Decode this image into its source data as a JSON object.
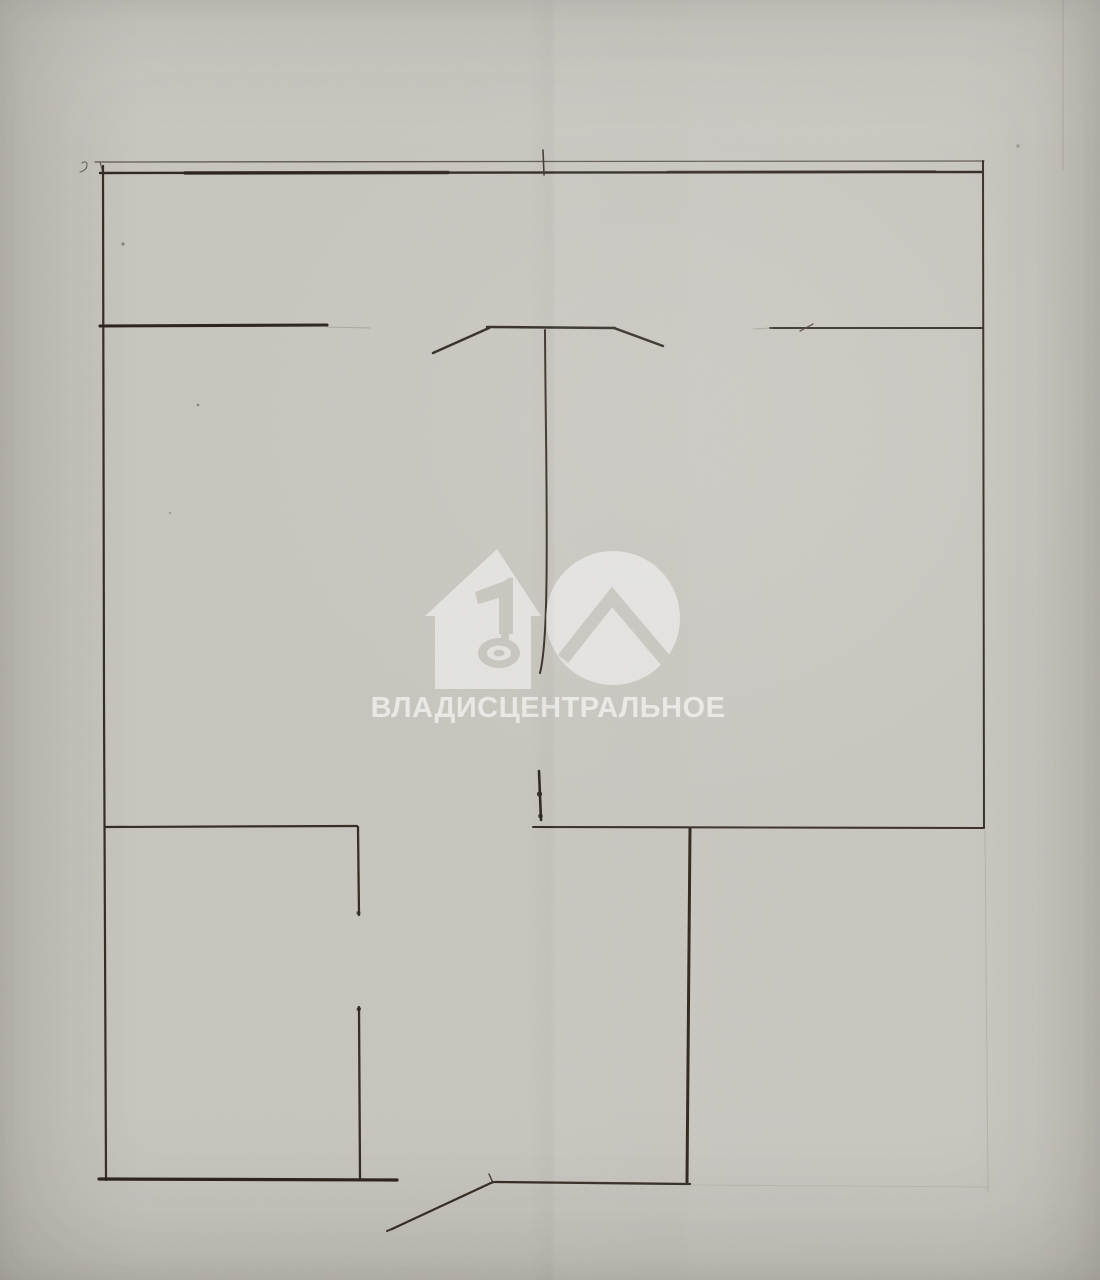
{
  "watermark": {
    "label": "ВЛАДИСЦЕНТРАЛЬНОЕ",
    "fill_color": "rgba(255,255,255,0.5)",
    "logo_icons": [
      "house-icon",
      "number-1-key-icon",
      "circle-roof-icon"
    ]
  },
  "paper": {
    "base_color": "#c7c5be",
    "ink_color": "#2e2720",
    "crease_color": "#a3998b"
  },
  "floorplan": {
    "description": "hand-drawn apartment floor plan",
    "lines": [
      {
        "x1": 95,
        "y1": 162,
        "x2": 984,
        "y2": 161,
        "w": 1.3,
        "c": "#5a5249",
        "o": 0.95
      },
      {
        "x1": 100,
        "y1": 162,
        "x2": 103,
        "y2": 173,
        "w": 1.2,
        "c": "#5a5249",
        "o": 0.9
      },
      {
        "x1": 100,
        "y1": 173,
        "x2": 983,
        "y2": 172,
        "w": 2.4,
        "c": "#2e2720",
        "o": 1
      },
      {
        "x1": 185,
        "y1": 173,
        "x2": 448,
        "y2": 172.5,
        "w": 3.4,
        "c": "#2a2219",
        "o": 0.85
      },
      {
        "x1": 668,
        "y1": 172,
        "x2": 935,
        "y2": 171.5,
        "w": 2.8,
        "c": "#2a2219",
        "o": 0.55
      },
      {
        "x1": 543,
        "y1": 150,
        "x2": 544,
        "y2": 175,
        "w": 1.6,
        "c": "#3b332a",
        "o": 0.95
      },
      {
        "x1": 103,
        "y1": 166,
        "x2": 104,
        "y2": 700,
        "w": 2.2,
        "c": "#332b22",
        "o": 1
      },
      {
        "x1": 104,
        "y1": 700,
        "x2": 106,
        "y2": 1180,
        "w": 2.2,
        "c": "#332b22",
        "o": 1
      },
      {
        "x1": 983,
        "y1": 161,
        "x2": 984,
        "y2": 828,
        "w": 2.0,
        "c": "#332b22",
        "o": 1
      },
      {
        "x1": 100,
        "y1": 326,
        "x2": 327,
        "y2": 325,
        "w": 3.1,
        "c": "#29211a",
        "o": 1
      },
      {
        "x1": 327,
        "y1": 327,
        "x2": 370,
        "y2": 328,
        "w": 1.1,
        "c": "#8d857a",
        "o": 0.5
      },
      {
        "x1": 433,
        "y1": 353,
        "x2": 489,
        "y2": 328,
        "w": 2.5,
        "c": "#2e2720",
        "o": 1
      },
      {
        "x1": 487,
        "y1": 327,
        "x2": 615,
        "y2": 328,
        "w": 2.5,
        "c": "#2e2720",
        "o": 1
      },
      {
        "x1": 614,
        "y1": 328,
        "x2": 663,
        "y2": 346,
        "w": 2.5,
        "c": "#2e2720",
        "o": 1
      },
      {
        "x1": 770,
        "y1": 328,
        "x2": 983,
        "y2": 328,
        "w": 2.0,
        "c": "#332b22",
        "o": 1
      },
      {
        "x1": 753,
        "y1": 329,
        "x2": 772,
        "y2": 328,
        "w": 1.0,
        "c": "#8d857a",
        "o": 0.5
      },
      {
        "x1": 800,
        "y1": 331,
        "x2": 813,
        "y2": 324,
        "w": 1.4,
        "c": "#453c32",
        "o": 0.85
      },
      {
        "x1": 105,
        "y1": 827,
        "x2": 357,
        "y2": 826,
        "w": 2.2,
        "c": "#332b22",
        "o": 1
      },
      {
        "x1": 533,
        "y1": 827,
        "x2": 983,
        "y2": 828,
        "w": 2.1,
        "c": "#332b22",
        "o": 1
      },
      {
        "x1": 539,
        "y1": 771,
        "x2": 541,
        "y2": 820,
        "w": 2.6,
        "c": "#2e2720",
        "o": 1
      },
      {
        "x1": 358,
        "y1": 827,
        "x2": 359,
        "y2": 915,
        "w": 2.3,
        "c": "#332b22",
        "o": 1
      },
      {
        "x1": 359,
        "y1": 1007,
        "x2": 360,
        "y2": 1178,
        "w": 2.3,
        "c": "#332b22",
        "o": 1
      },
      {
        "x1": 690,
        "y1": 829,
        "x2": 687,
        "y2": 1182,
        "w": 3.0,
        "c": "#2a2219",
        "o": 1
      },
      {
        "x1": 99,
        "y1": 1179,
        "x2": 397,
        "y2": 1180,
        "w": 3.2,
        "c": "#2a2219",
        "o": 1
      },
      {
        "x1": 495,
        "y1": 1182,
        "x2": 690,
        "y2": 1184,
        "w": 2.3,
        "c": "#332b22",
        "o": 1
      },
      {
        "x1": 493,
        "y1": 1182,
        "x2": 392,
        "y2": 1229,
        "w": 2.2,
        "c": "#332b22",
        "o": 1
      },
      {
        "x1": 392,
        "y1": 1229,
        "x2": 387,
        "y2": 1231,
        "w": 2.2,
        "c": "#332b22",
        "o": 0.9
      },
      {
        "x1": 493,
        "y1": 1183,
        "x2": 489,
        "y2": 1174,
        "w": 1.5,
        "c": "#332b22",
        "o": 0.85
      },
      {
        "x1": 985,
        "y1": 831,
        "x2": 988,
        "y2": 1192,
        "w": 1.2,
        "c": "#a3998b",
        "o": 0.4
      },
      {
        "x1": 692,
        "y1": 1185,
        "x2": 988,
        "y2": 1187,
        "w": 1.1,
        "c": "#a3998b",
        "o": 0.3
      },
      {
        "x1": 1063,
        "y1": 0,
        "x2": 1063,
        "y2": 170,
        "w": 1.3,
        "c": "#a79d90",
        "o": 0.45
      }
    ],
    "paths": [
      {
        "d": "M545,330 C545.5,420 547.5,505 546.5,580 C546,628 544,657 540,673",
        "w": 2.0,
        "c": "#362e25",
        "o": 1
      },
      {
        "d": "M82,163 q5,-3 5,2 q0,5 -7,7",
        "w": 1.1,
        "c": "#4a4339",
        "o": 0.75
      }
    ],
    "dots": [
      {
        "cx": 539.5,
        "cy": 794,
        "r": 2.6,
        "c": "#2e2720",
        "o": 0.9
      },
      {
        "cx": 540.5,
        "cy": 816,
        "r": 2.3,
        "c": "#2e2720",
        "o": 0.9
      },
      {
        "cx": 358.8,
        "cy": 1009,
        "r": 2.2,
        "c": "#2e2720",
        "o": 0.85
      },
      {
        "cx": 358.5,
        "cy": 913,
        "r": 2.0,
        "c": "#2e2720",
        "o": 0.8
      },
      {
        "cx": 123,
        "cy": 244,
        "r": 1.6,
        "c": "#6b6459",
        "o": 0.7
      },
      {
        "cx": 198,
        "cy": 405,
        "r": 1.4,
        "c": "#6b6459",
        "o": 0.65
      },
      {
        "cx": 170,
        "cy": 513,
        "r": 1.2,
        "c": "#7d7669",
        "o": 0.5
      },
      {
        "cx": 1018,
        "cy": 146,
        "r": 1.7,
        "c": "#8a8276",
        "o": 0.6
      }
    ]
  }
}
